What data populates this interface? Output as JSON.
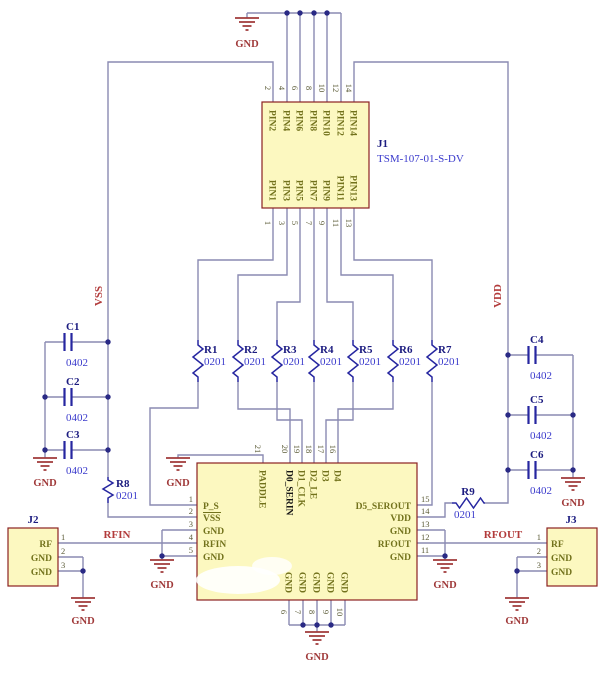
{
  "colors": {
    "wire": "#8a8ab2",
    "junction": "#2a2a85",
    "part_outline": "#2626a0",
    "component_fill": "#fcf8c0",
    "component_border": "#8b2121",
    "designator": "#1c1c80",
    "value": "#3a3acc",
    "pin_name": "#72721c",
    "net_label": "#b23b3b",
    "ground": "#a03a3a",
    "background": "#ffffff"
  },
  "j1": {
    "designator": "J1",
    "part_number": "TSM-107-01-S-DV",
    "top_pins": [
      {
        "n": "2",
        "name": "PIN2"
      },
      {
        "n": "4",
        "name": "PIN4"
      },
      {
        "n": "6",
        "name": "PIN6"
      },
      {
        "n": "8",
        "name": "PIN8"
      },
      {
        "n": "10",
        "name": "PIN10"
      },
      {
        "n": "12",
        "name": "PIN12"
      },
      {
        "n": "14",
        "name": "PIN14"
      }
    ],
    "bottom_pins": [
      {
        "n": "1",
        "name": "PIN1"
      },
      {
        "n": "3",
        "name": "PIN3"
      },
      {
        "n": "5",
        "name": "PIN5"
      },
      {
        "n": "7",
        "name": "PIN7"
      },
      {
        "n": "9",
        "name": "PIN9"
      },
      {
        "n": "11",
        "name": "PIN11"
      },
      {
        "n": "13",
        "name": "PIN13"
      }
    ]
  },
  "ic": {
    "left_pins": [
      {
        "n": "1",
        "name": "P_S"
      },
      {
        "n": "2",
        "name": "VSS"
      },
      {
        "n": "3",
        "name": "GND"
      },
      {
        "n": "4",
        "name": "RFIN"
      },
      {
        "n": "5",
        "name": "GND"
      }
    ],
    "top_pins": [
      {
        "n": "21",
        "name": "PADDLE"
      },
      {
        "n": "20",
        "name": "D0_SERIN"
      },
      {
        "n": "19",
        "name": "D1_CLK"
      },
      {
        "n": "18",
        "name": "D2_LE"
      },
      {
        "n": "17",
        "name": "D3"
      },
      {
        "n": "16",
        "name": "D4"
      }
    ],
    "right_pins": [
      {
        "n": "15",
        "name": "D5_SEROUT"
      },
      {
        "n": "14",
        "name": "VDD"
      },
      {
        "n": "13",
        "name": "GND"
      },
      {
        "n": "12",
        "name": "RFOUT"
      },
      {
        "n": "11",
        "name": "GND"
      }
    ],
    "bottom_pins": [
      {
        "n": "6",
        "name": "GND"
      },
      {
        "n": "7",
        "name": "GND"
      },
      {
        "n": "8",
        "name": "GND"
      },
      {
        "n": "9",
        "name": "GND"
      },
      {
        "n": "10",
        "name": "GND"
      }
    ]
  },
  "resistors": [
    {
      "designator": "R1",
      "value": "0201"
    },
    {
      "designator": "R2",
      "value": "0201"
    },
    {
      "designator": "R3",
      "value": "0201"
    },
    {
      "designator": "R4",
      "value": "0201"
    },
    {
      "designator": "R5",
      "value": "0201"
    },
    {
      "designator": "R6",
      "value": "0201"
    },
    {
      "designator": "R7",
      "value": "0201"
    },
    {
      "designator": "R8",
      "value": "0201"
    },
    {
      "designator": "R9",
      "value": "0201"
    }
  ],
  "capacitors": [
    {
      "designator": "C1",
      "value": "0402"
    },
    {
      "designator": "C2",
      "value": "0402"
    },
    {
      "designator": "C3",
      "value": "0402"
    },
    {
      "designator": "C4",
      "value": "0402"
    },
    {
      "designator": "C5",
      "value": "0402"
    },
    {
      "designator": "C6",
      "value": "0402"
    }
  ],
  "j2": {
    "designator": "J2",
    "pins": [
      {
        "n": "1",
        "name": "RF"
      },
      {
        "n": "2",
        "name": "GND"
      },
      {
        "n": "3",
        "name": "GND"
      }
    ]
  },
  "j3": {
    "designator": "J3",
    "pins": [
      {
        "n": "1",
        "name": "RF"
      },
      {
        "n": "2",
        "name": "GND"
      },
      {
        "n": "3",
        "name": "GND"
      }
    ]
  },
  "nets": {
    "vss": "VSS",
    "vdd": "VDD",
    "rfin": "RFIN",
    "rfout": "RFOUT",
    "gnd": "GND"
  }
}
